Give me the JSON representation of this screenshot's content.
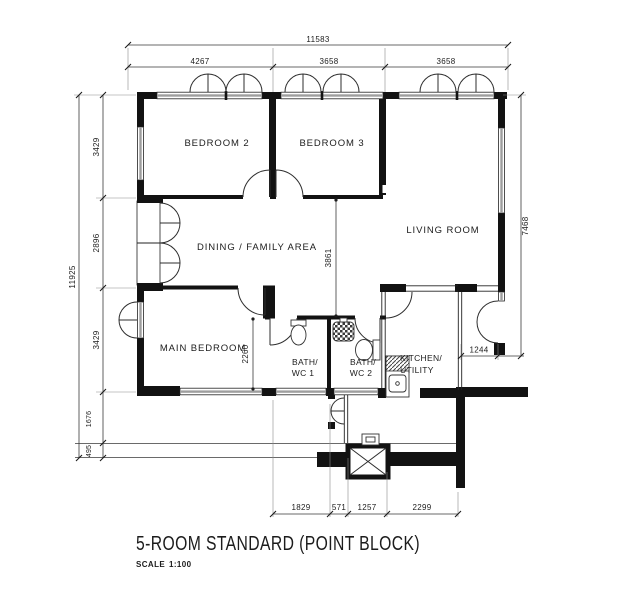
{
  "title": {
    "name": "5-ROOM STANDARD (POINT BLOCK)",
    "scale_label": "SCALE",
    "scale_value": "1:100"
  },
  "rooms": {
    "bedroom2": "BEDROOM 2",
    "bedroom3": "BEDROOM 3",
    "living": "LIVING ROOM",
    "dining": "DINING / FAMILY AREA",
    "main_bedroom": "MAIN BEDROOM",
    "bath1_line1": "BATH/",
    "bath1_line2": "WC 1",
    "bath2_line1": "BATH/",
    "bath2_line2": "WC 2",
    "kitchen_line1": "KITCHEN/",
    "kitchen_line2": "UTILITY"
  },
  "dims": {
    "top_total": "11583",
    "top1": "4267",
    "top2": "3658",
    "top3": "3658",
    "left_total": "11925",
    "left1": "3429",
    "left2": "2896",
    "left3": "3429",
    "left4": "1676",
    "left5": "495",
    "right1": "7468",
    "right2": "1244",
    "mid1": "3861",
    "mid2": "2260",
    "bottom1": "1829",
    "bottom2": "571",
    "bottom3": "1257",
    "bottom4": "2299"
  },
  "colors": {
    "wall": "#121212",
    "window_fill": "#9e9e9e",
    "line": "#333333",
    "background": "#ffffff"
  }
}
